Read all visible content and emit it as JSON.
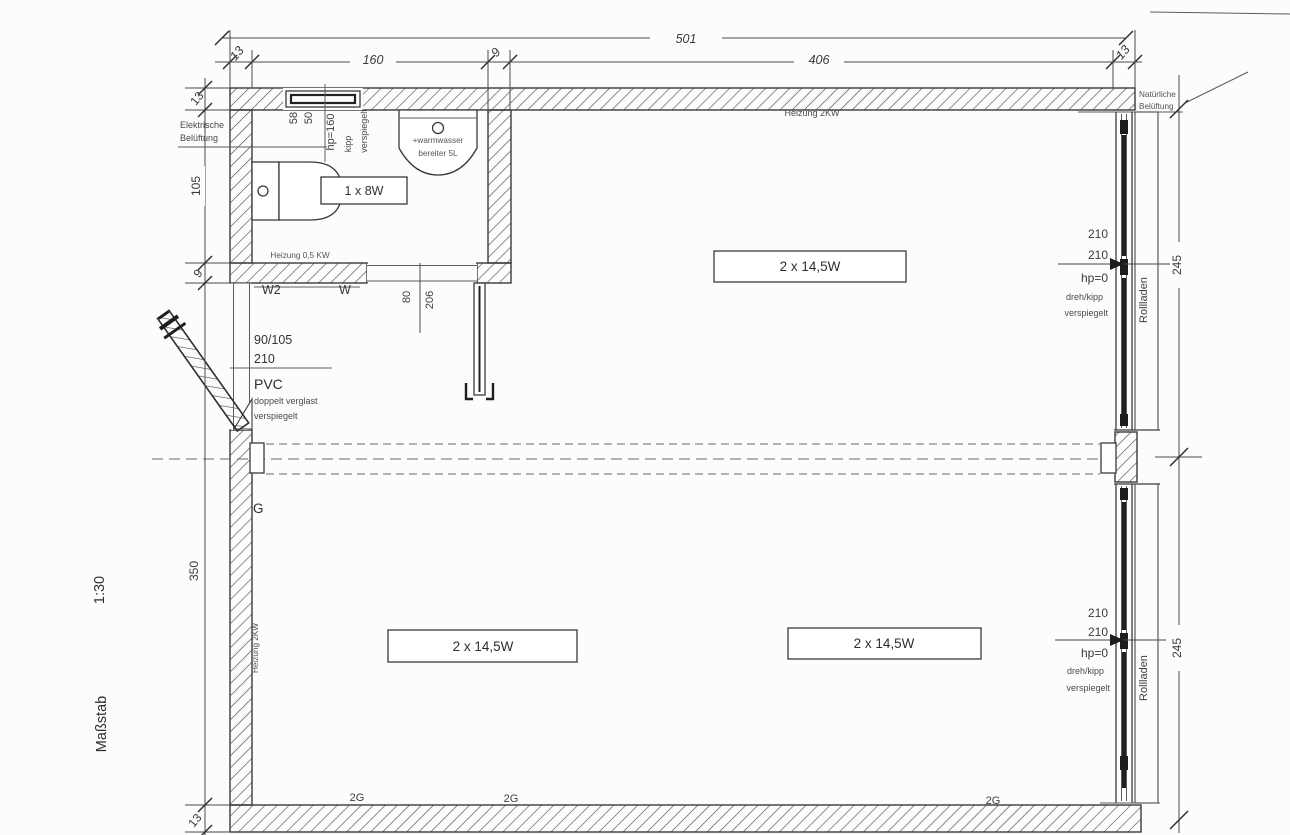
{
  "scale": {
    "label": "Maßstab",
    "value": "1:30"
  },
  "dims": {
    "total_width": "501",
    "top": [
      "13",
      "160",
      "9",
      "406",
      "13"
    ],
    "left": [
      "13",
      "105",
      "9",
      "350",
      "13"
    ],
    "right_top": "245",
    "right_bottom": "245"
  },
  "bath": {
    "vent_line1": "Elektrische",
    "vent_line2": "Belüftung",
    "win_w1": "58",
    "win_w2": "50",
    "win_hp": "hp=160",
    "win_open": "kipp",
    "win_glass": "verspiegelt",
    "boiler_line1": "+warmwasser",
    "boiler_line2": "bereiter 5L",
    "light": "1 x 8W",
    "heating": "Heizung 0,5 KW",
    "door_w2": "W2",
    "door_w": "W",
    "door_width": "80",
    "door_height": "206"
  },
  "entry_door": {
    "size": "90/105",
    "height": "210",
    "material": "PVC",
    "glazing": "doppelt verglast",
    "coating": "verspiegelt",
    "mark": "G"
  },
  "room": {
    "heating_top": "Heizung 2KW",
    "heating_left": "Heizung 2KW",
    "light1": "2 x 14,5W",
    "light2": "2 x 14,5W",
    "light3": "2 x 14,5W",
    "socket1": "2G",
    "socket2": "2G",
    "socket3": "2G"
  },
  "window_right_top": {
    "h1": "210",
    "h2": "210",
    "hp": "hp=0",
    "open": "dreh/kipp",
    "glass": "verspiegelt",
    "shutter": "Rollladen",
    "vent_line1": "Natürliche",
    "vent_line2": "Belüftung"
  },
  "window_right_bottom": {
    "h1": "210",
    "h2": "210",
    "hp": "hp=0",
    "open": "dreh/kipp",
    "glass": "verspiegelt",
    "shutter": "Rollladen"
  }
}
